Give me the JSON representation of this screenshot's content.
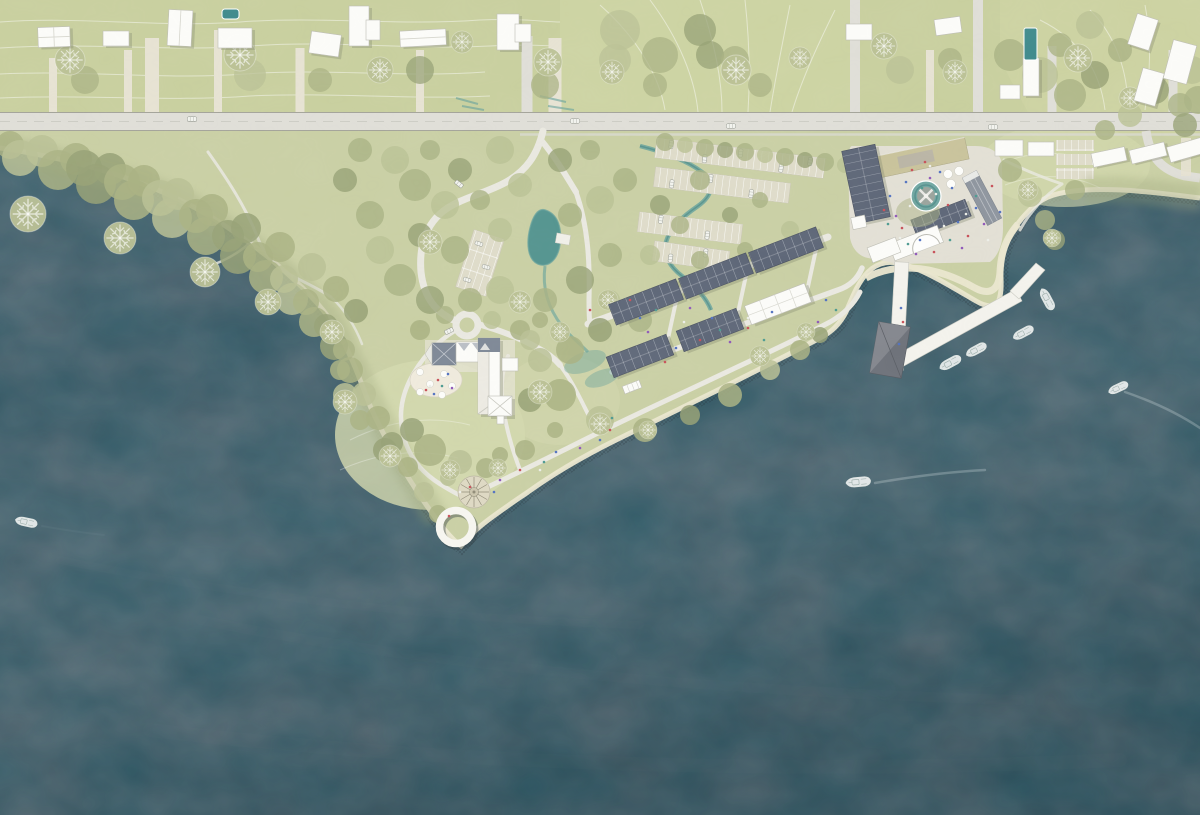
{
  "scene": {
    "type": "architectural coastal masterplan site plan (top view rendering)",
    "water_position": "south and west",
    "text_labels": ""
  },
  "colors": {
    "water": "#4c616c",
    "waterDeep": "#45римор5b66",
    "land": "#c9cfa4",
    "lawnTop": "#c8cf9e",
    "field": "#cdd3a2",
    "lawnLight": "#d3d8ae",
    "canopy": "#a9b183",
    "canopyLight": "#b9c094",
    "canopyDark": "#97a175",
    "beach": "#eae6cf",
    "road": "#dfded7",
    "roadEdge": "#a3a399",
    "path": "#e9e8e0",
    "white": "#fbfbf8",
    "shadow": "#b9b9b1",
    "roofDark": "#5d6677",
    "roofGray": "#8e959e",
    "roofBlue": "#7e8896",
    "tan": "#c8c29a",
    "pier": "#f3f2ec",
    "pierBld": "#6e727a",
    "pool": "#3f8a8c",
    "stream": "#63a09b",
    "plaza": "#e2dfd4",
    "terrace": "#efeadc",
    "stall": "#dedbc9",
    "contour": "#ffffff",
    "peopleRed": "#c75058",
    "peopleBlue": "#5272c0",
    "peoplePurple": "#8f58b8",
    "peopleTeal": "#4d9a90",
    "peopleWhite": "#eceee8"
  },
  "features": {
    "main_road": "east-west road with cars and side streets",
    "residential_north": "detached houses with driveways and two swimming pools",
    "forest_shoreline": "dense tree canopy along western coast with beach edge",
    "park": "loop road, roundabout, pond, stream, small car park",
    "manor": "historic courtyard building with terrace cafe",
    "housing_rows": "six terraced housing rows with dark panel roofs",
    "parking": "four angled parking banks crossed by a creek",
    "harbor_plaza": "paved plaza with circular pond pavilion and umbrellas",
    "pier": "white breakwater pier with dark harbor building and moored boats",
    "point": "circular lawn plaza and white ring pier at the headland",
    "boats": "motor boats with wakes in open water"
  }
}
